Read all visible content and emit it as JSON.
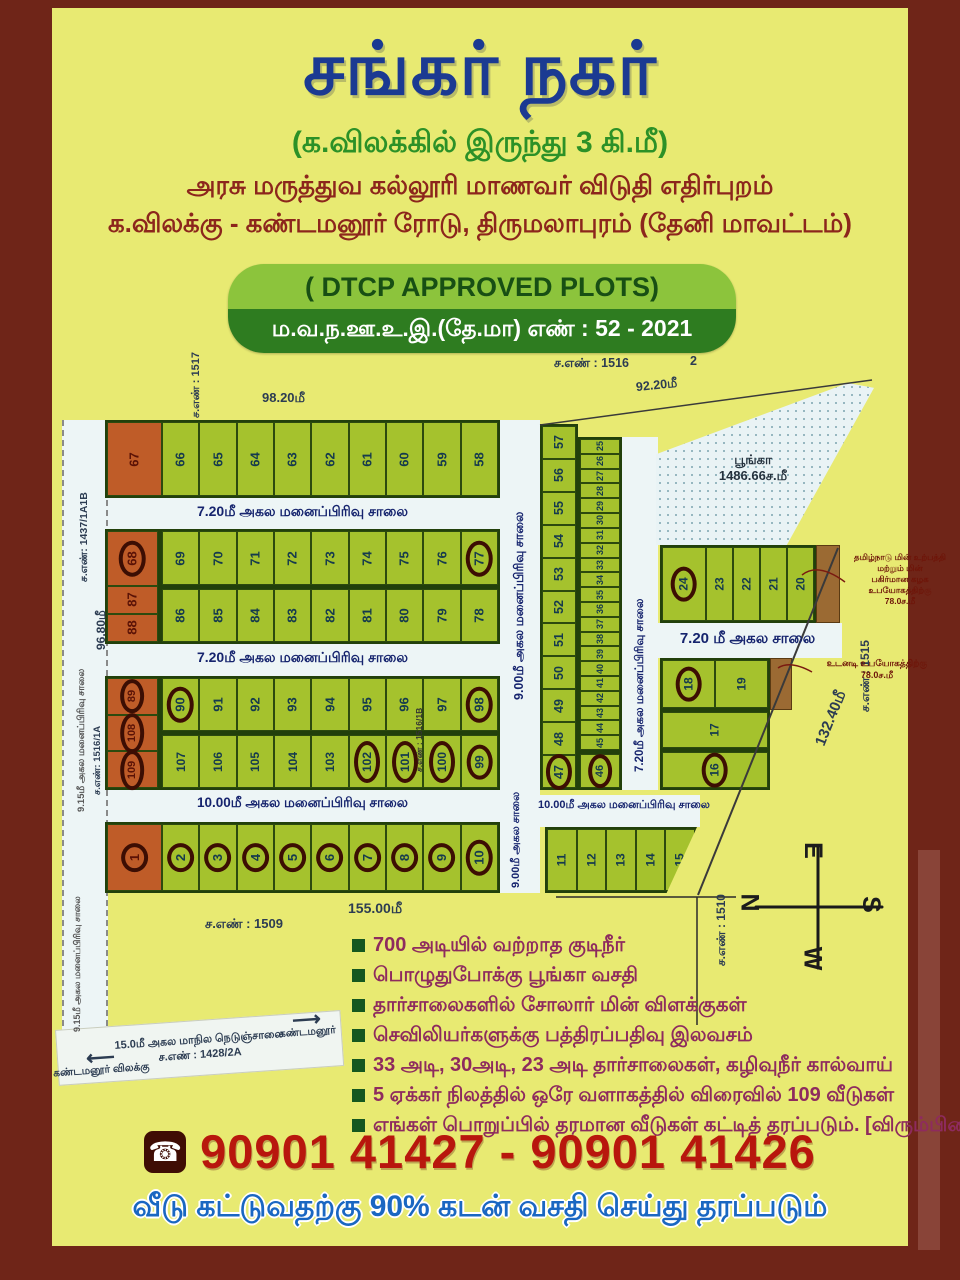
{
  "header": {
    "title": "சங்கர் நகர்",
    "subtitle": "(க.விலக்கில் இருந்து 3 கி.மீ)",
    "line1": "அரசு மருத்துவ கல்லூரி மாணவர் விடுதி எதிர்புறம்",
    "line2": "க.விலக்கு - கண்டமனூர் ரோடு, திருமலாபுரம் (தேனி மாவட்டம்)"
  },
  "approval": {
    "english": "( DTCP APPROVED PLOTS)",
    "tamil": "ம.வ.ந.ஊ.உ.இ.(தே.மா) எண் : 52 - 2021"
  },
  "map": {
    "sno_1517": "ச.எண் : 1517",
    "sno_1516": "ச.எண் : 1516",
    "sno_1516_suffix": "2",
    "sno_1437": "ச.எண்: 1437/1A1B",
    "sno_1516_1a": "ச.எண்: 1516/1A",
    "sno_1516_1b": "ச.எண் : 1516/1B",
    "sno_1509": "ச.எண் : 1509",
    "sno_1510": "ச.எண் : 1510",
    "sno_1515": "ச.எண் : 1515",
    "dim_9820": "98.20மீ",
    "dim_9220": "92.20மீ",
    "dim_9680": "96.80மீ",
    "dim_15500": "155.00மீ",
    "dim_13240": "132.40மீ",
    "road_720": "7.20மீ அகல மனைப்பிரிவு சாலை",
    "road_900_long": "9.00மீ அகல மனைப்பிரிவு சாலை",
    "road_900_short": "9.00மீ அகல சாலை",
    "road_1000": "10.00மீ அகல மனைப்பிரிவு சாலை",
    "road_720_short": "7.20 மீ அகல சாலை",
    "road_915": "9.15மீ அகல மனைப்பிரிவு சாலை",
    "highway_line1": "15.0மீ அகல மாநில நெடுஞ்சாலை",
    "sno_1428": "ச.எண் : 1428/2A",
    "arrow_right_label": "கண்டமனூர்",
    "arrow_left_label": "கண்டமனூர் விலக்கு",
    "park_line1": "பூங்கா",
    "park_line2": "1486.66ச.மீ",
    "note1_line1": "தமிழ்நாடு மின் உற்பத்தி மற்றும் மின்",
    "note1_line2": "பகிர்மான கழக உபயோகத்திற்கு",
    "note1_line3": "78.0ச.மீ",
    "note2_line1": "உடனடி உபயோகத்திற்கு",
    "note2_line2": "78.0ச.மீ",
    "compass": {
      "top": "E",
      "left": "N",
      "right": "S",
      "bottom": "W"
    },
    "blocks": {
      "rowA": [
        {
          "n": "67",
          "o": 1
        },
        {
          "n": "66"
        },
        {
          "n": "65"
        },
        {
          "n": "64"
        },
        {
          "n": "63"
        },
        {
          "n": "62"
        },
        {
          "n": "61"
        },
        {
          "n": "60"
        },
        {
          "n": "59"
        },
        {
          "n": "58"
        }
      ],
      "b2left": [
        {
          "n": "68",
          "o": 1,
          "c": 1
        },
        {
          "n": "87",
          "o": 1
        },
        {
          "n": "88",
          "o": 1
        }
      ],
      "b2top": [
        {
          "n": "69"
        },
        {
          "n": "70"
        },
        {
          "n": "71"
        },
        {
          "n": "72"
        },
        {
          "n": "73"
        },
        {
          "n": "74"
        },
        {
          "n": "75"
        },
        {
          "n": "76"
        },
        {
          "n": "77",
          "c": 1
        }
      ],
      "b2bottom": [
        {
          "n": "86"
        },
        {
          "n": "85"
        },
        {
          "n": "84"
        },
        {
          "n": "83"
        },
        {
          "n": "82"
        },
        {
          "n": "81"
        },
        {
          "n": "80"
        },
        {
          "n": "79"
        },
        {
          "n": "78"
        }
      ],
      "b3left": [
        {
          "n": "89",
          "o": 1,
          "c": 1
        },
        {
          "n": "108",
          "o": 1,
          "c": 1
        },
        {
          "n": "109",
          "o": 1,
          "c": 1
        }
      ],
      "b3top": [
        {
          "n": "90",
          "c": 1
        },
        {
          "n": "91"
        },
        {
          "n": "92"
        },
        {
          "n": "93"
        },
        {
          "n": "94"
        },
        {
          "n": "95"
        },
        {
          "n": "96"
        },
        {
          "n": "97"
        },
        {
          "n": "98",
          "c": 1
        }
      ],
      "b3bottom": [
        {
          "n": "107"
        },
        {
          "n": "106"
        },
        {
          "n": "105"
        },
        {
          "n": "104"
        },
        {
          "n": "103"
        },
        {
          "n": "102",
          "c": 1
        },
        {
          "n": "101",
          "c": 1
        },
        {
          "n": "100",
          "c": 1
        },
        {
          "n": "99",
          "c": 1
        }
      ],
      "bottomRow": [
        {
          "n": "1",
          "o": 1,
          "c": 1
        },
        {
          "n": "2",
          "c": 1
        },
        {
          "n": "3",
          "c": 1
        },
        {
          "n": "4",
          "c": 1
        },
        {
          "n": "5",
          "c": 1
        },
        {
          "n": "6",
          "c": 1
        },
        {
          "n": "7",
          "c": 1
        },
        {
          "n": "8",
          "c": 1
        },
        {
          "n": "9",
          "c": 1
        },
        {
          "n": "10",
          "c": 1
        }
      ],
      "rightCol": [
        {
          "n": "57"
        },
        {
          "n": "56"
        },
        {
          "n": "55"
        },
        {
          "n": "54"
        },
        {
          "n": "53"
        },
        {
          "n": "52"
        },
        {
          "n": "51"
        },
        {
          "n": "50"
        },
        {
          "n": "49"
        },
        {
          "n": "48"
        },
        {
          "n": "47",
          "c": 1
        }
      ],
      "strip": [
        {
          "n": "25"
        },
        {
          "n": "26"
        },
        {
          "n": "27"
        },
        {
          "n": "28"
        },
        {
          "n": "29"
        },
        {
          "n": "30"
        },
        {
          "n": "31"
        },
        {
          "n": "32"
        },
        {
          "n": "33"
        },
        {
          "n": "34"
        },
        {
          "n": "35"
        },
        {
          "n": "36"
        },
        {
          "n": "37"
        },
        {
          "n": "38"
        },
        {
          "n": "39"
        },
        {
          "n": "40"
        },
        {
          "n": "41"
        },
        {
          "n": "42"
        },
        {
          "n": "43"
        },
        {
          "n": "44"
        },
        {
          "n": "45"
        }
      ],
      "strip46": [
        {
          "n": "46",
          "c": 1
        }
      ],
      "blk20": [
        {
          "n": "24",
          "c": 1
        },
        {
          "n": "23"
        },
        {
          "n": "22"
        },
        {
          "n": "21"
        },
        {
          "n": "20"
        }
      ],
      "blk16r1": [
        {
          "n": "18",
          "c": 1
        },
        {
          "n": "19"
        }
      ],
      "blk16r2": [
        {
          "n": "17"
        }
      ],
      "blk16r3": [
        {
          "n": "16",
          "c": 1
        }
      ],
      "blk11": [
        {
          "n": "11"
        },
        {
          "n": "12"
        },
        {
          "n": "13"
        },
        {
          "n": "14"
        },
        {
          "n": "15"
        }
      ]
    }
  },
  "features": {
    "items": [
      "700 அடியில் வற்றாத குடிநீர்",
      "பொழுதுபோக்கு பூங்கா வசதி",
      "தார்சாலைகளில் சோலார் மின் விளக்குகள்",
      "செவிலியர்களுக்கு பத்திரப்பதிவு இலவசம்",
      "33 அடி, 30அடி, 23 அடி தார்சாலைகள், கழிவுநீர் கால்வாய்",
      "5 ஏக்கர் நிலத்தில் ஒரே வளாகத்தில் விரைவில் 109 வீடுகள்",
      "எங்கள் பொறுப்பில் தரமான வீடுகள் கட்டித் தரப்படும். [விரும்பினால்]"
    ]
  },
  "contact": {
    "phone": "90901 41427 - 90901 41426",
    "phone_icon": "☎"
  },
  "footer": {
    "loan": "வீடு கட்டுவதற்கு 90% கடன் வசதி செய்து தரப்படும்"
  }
}
